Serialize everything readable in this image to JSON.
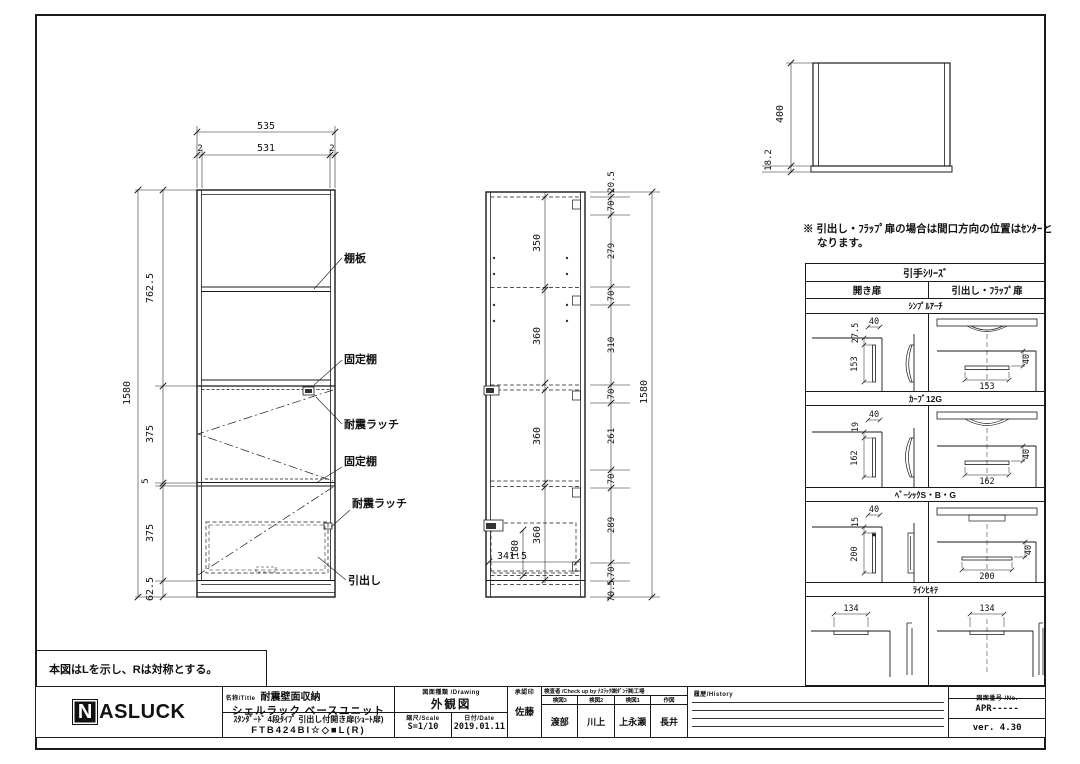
{
  "front_view": {
    "top_dims": [
      "535",
      "2",
      "531",
      "2"
    ],
    "left_dims": [
      "1580",
      "762.5",
      "375",
      "5",
      "375",
      "62.5"
    ],
    "labels": [
      "棚板",
      "固定棚",
      "耐震ラッチ",
      "固定棚",
      "耐震ラッチ",
      "引出し"
    ]
  },
  "side_view": {
    "inner_dims": [
      "350",
      "360",
      "360",
      "360"
    ],
    "drawer_dims": [
      "180",
      "341.5"
    ],
    "right_chain": [
      "20.5",
      "70",
      "279",
      "70",
      "310",
      "70",
      "261",
      "70",
      "289",
      "70",
      "70.5"
    ],
    "total_height": "1580"
  },
  "top_view": {
    "depth": "400",
    "base_height": "18.2"
  },
  "notes": {
    "handle_note_line1": "※ 引出し・ﾌﾗｯﾌﾟ扉の場合は間口方向の位置はｾﾝﾀｰと",
    "handle_note_line2": "なります。",
    "mirror_note": "本図はLを示し、Rは対称とする。"
  },
  "handle_table": {
    "title": "引手ｼﾘｰｽﾞ",
    "columns": [
      "開き扉",
      "引出し・ﾌﾗｯﾌﾟ扉"
    ],
    "height_dim": "40",
    "sections": [
      {
        "name": "ｼﾝﾌﾟﾙｱｰﾁ",
        "offset": "27.5",
        "width": "40",
        "length": "153"
      },
      {
        "name": "ｶｰﾌﾞ12G",
        "offset": "19",
        "width": "40",
        "length": "162"
      },
      {
        "name": "ﾍﾞｰｼｯｸS・B・G",
        "offset": "15",
        "width": "40",
        "length": "200"
      },
      {
        "name": "ﾗｲﾝﾋｷﾃ",
        "length": "134"
      }
    ]
  },
  "title_block": {
    "brand_n": "N",
    "brand_rest": "ASLUCK",
    "name_label": "名称/Title",
    "product_category": "耐震壁面収納",
    "product_name": "シェルラック ベースユニット",
    "product_spec": "ｽﾀﾝﾀﾞｰﾄﾞ 4段ﾀｲﾌﾟ 引出し付開き扉(ｼｮｰﾄ扉)",
    "model_number": "FTB424BI☆◇■L(R)",
    "drawing_label": "図面種類 /Drawing",
    "drawing_type": "外観図",
    "scale_label": "縮尺/Scale",
    "scale_value": "S=1/10",
    "date_label": "日付/Date",
    "date_value": "2019.01.11",
    "approval_label": "承認印",
    "approver": "佐藤",
    "check_header": "検査者 /Check up by ﾅｽﾗｯｸ㈱ﾀﾞﾝﾃ㈱工場",
    "checkers": [
      {
        "label": "検図3",
        "name": "渡部"
      },
      {
        "label": "検図2",
        "name": "川上"
      },
      {
        "label": "検図1",
        "name": "上永瀬"
      },
      {
        "label": "作図",
        "name": "長井"
      }
    ],
    "history_label": "履歴/History",
    "number_label": "図面番号 /No.",
    "drawing_number": "APR-----",
    "version": "ver. 4.30"
  }
}
